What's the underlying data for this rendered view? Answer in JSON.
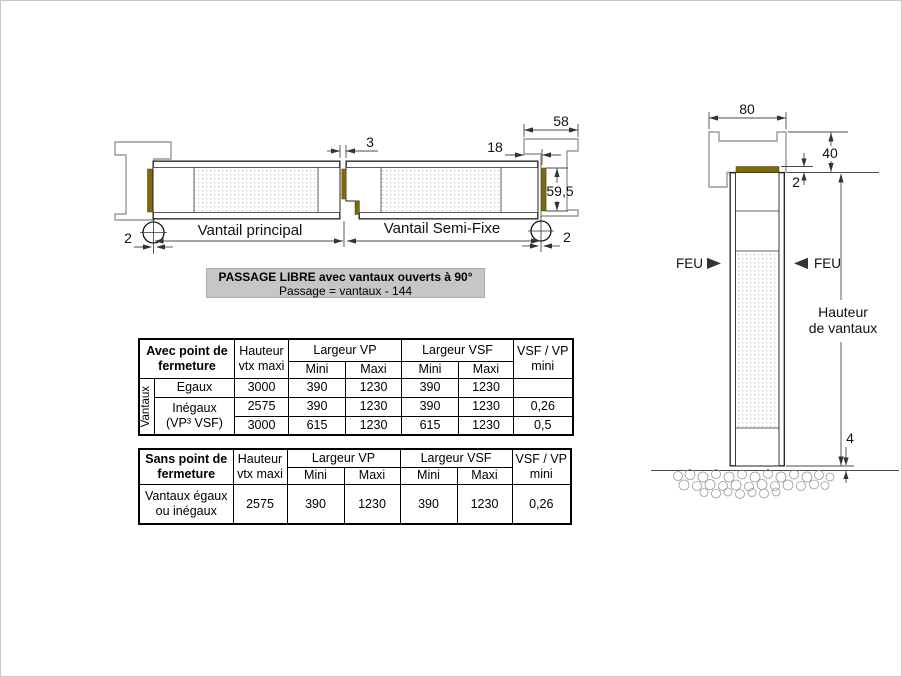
{
  "plan": {
    "vantail_principal": "Vantail principal",
    "vantail_semi_fixe": "Vantail Semi-Fixe",
    "dim_gap": "3",
    "dim_recouvrement": "18",
    "dim_dormant": "58",
    "dim_epaisseur": "59,5",
    "dim_jeu_gauche": "2",
    "dim_jeu_droit": "2"
  },
  "note": {
    "line1": "PASSAGE LIBRE  avec vantaux ouverts à 90°",
    "line2": "Passage = vantaux - 144"
  },
  "section": {
    "dim_largeur_dormant": "80",
    "dim_hauteur_dormant": "40",
    "dim_jeu_haut": "2",
    "dim_jeu_sol": "4",
    "feu_gauche": "FEU",
    "feu_droit": "FEU",
    "hauteur_label": [
      "Hauteur",
      "de vantaux"
    ]
  },
  "table_avec": {
    "title": [
      "Avec point de",
      "fermeture"
    ],
    "hauteur": [
      "Hauteur",
      "vtx maxi"
    ],
    "largeur_vp": "Largeur VP",
    "largeur_vsf": "Largeur VSF",
    "ratio_head": [
      "VSF / VP",
      "mini"
    ],
    "mini": "Mini",
    "maxi": "Maxi",
    "side": "Vantaux",
    "r1": {
      "label": "Egaux",
      "h": "3000",
      "vpmin": "390",
      "vpmax": "1230",
      "vsfmin": "390",
      "vsfmax": "1230",
      "ratio": ""
    },
    "r23_label": [
      "Inégaux",
      "(VP³ VSF)"
    ],
    "r2": {
      "h": "2575",
      "vpmin": "390",
      "vpmax": "1230",
      "vsfmin": "390",
      "vsfmax": "1230",
      "ratio": "0,26"
    },
    "r3": {
      "h": "3000",
      "vpmin": "615",
      "vpmax": "1230",
      "vsfmin": "615",
      "vsfmax": "1230",
      "ratio": "0,5"
    }
  },
  "table_sans": {
    "title": [
      "Sans point de",
      "fermeture"
    ],
    "hauteur": [
      "Hauteur",
      "vtx maxi"
    ],
    "largeur_vp": "Largeur VP",
    "largeur_vsf": "Largeur VSF",
    "ratio_head": [
      "VSF / VP",
      "mini"
    ],
    "mini": "Mini",
    "maxi": "Maxi",
    "row_label": [
      "Vantaux égaux",
      "ou inégaux"
    ],
    "r1": {
      "h": "2575",
      "vpmin": "390",
      "vpmax": "1230",
      "vsfmin": "390",
      "vsfmax": "1230",
      "ratio": "0,26"
    }
  },
  "colors": {
    "seal": "#7d680c",
    "note_bg": "#c6c6c6",
    "outline": "#222222",
    "profile": "#979797"
  }
}
